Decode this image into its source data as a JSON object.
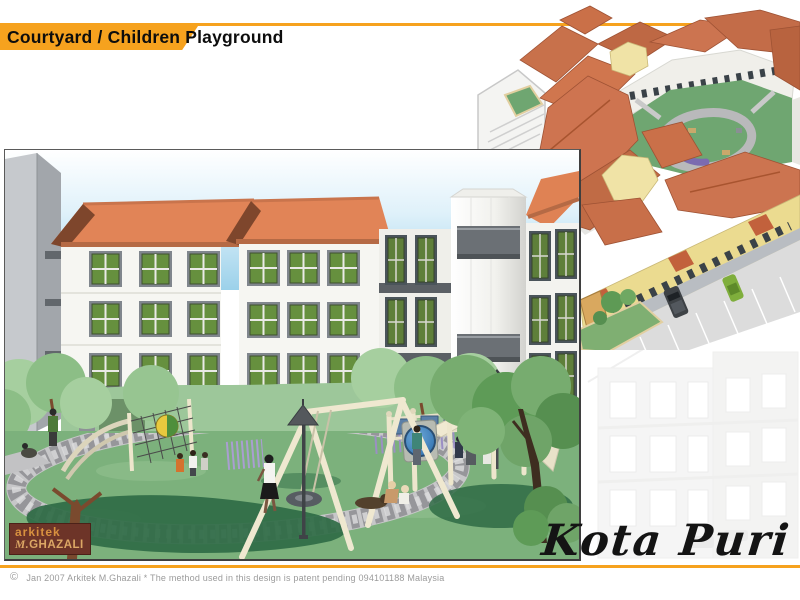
{
  "header": {
    "title": "Courtyard / Children Playground",
    "accent_color": "#F6A21E"
  },
  "main_view": {
    "caption": "courtyard children playground perspective rendering",
    "logo": {
      "line1": "arkitek",
      "line2_initial": "M.",
      "line2_rest": "GHAZALI"
    },
    "colors": {
      "sky": "#9BD1EA",
      "roof": "#E18457",
      "facade": "#F6F6F2",
      "window_glass": "#66903E",
      "grass": "#7CB17C",
      "tree_shadow": "#2F6B45",
      "stone_path": "#C7C7C9",
      "equipment_cream": "#EFE8D0",
      "porthole_blue": "#2C6FAE"
    }
  },
  "aerial_view": {
    "caption": "aerial view of courtyard housing block",
    "colors": {
      "roof": "#CC7450",
      "courtyard_green": "#6FA671",
      "facade_yellow": "#EBDB90",
      "street": "#DBDBDB",
      "car_dark": "#3E4246",
      "car_green": "#7FAE3C"
    }
  },
  "background_view": {
    "caption": "faded building facade"
  },
  "project": {
    "name": "Kota Puri"
  },
  "footer": {
    "copyright_symbol": "©",
    "text": "Jan 2007 Arkitek M.Ghazali  * The method used in this design is patent pending 094101188 Malaysia",
    "line_color": "#F6A21E"
  }
}
